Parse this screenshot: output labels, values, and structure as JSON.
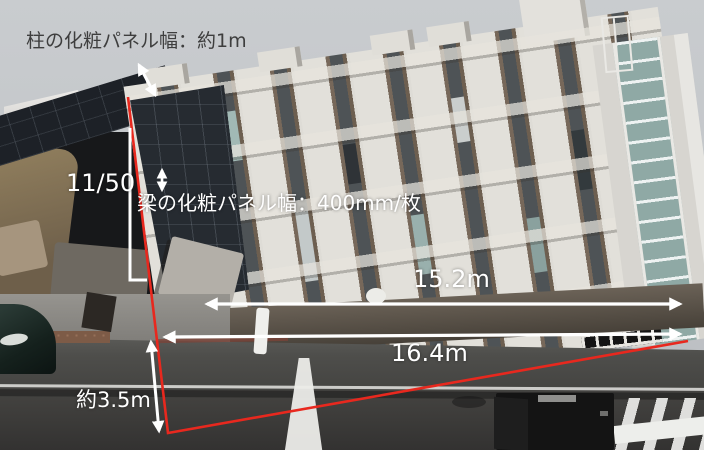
{
  "annotations": {
    "column_panel": "柱の化粧パネル幅：約1m",
    "tilt_ratio": "11/50",
    "beam_panel": "梁の化粧パネル幅：400mm/枚",
    "width_upper": "15.2m",
    "width_lower": "16.4m",
    "height_left": "約3.5m"
  },
  "colors": {
    "survey_line_red": "#e8281e",
    "measure_arrow_white": "#ffffff",
    "top_label_text": "#3e3e3e",
    "overlay_label_text": "#ffffff"
  }
}
